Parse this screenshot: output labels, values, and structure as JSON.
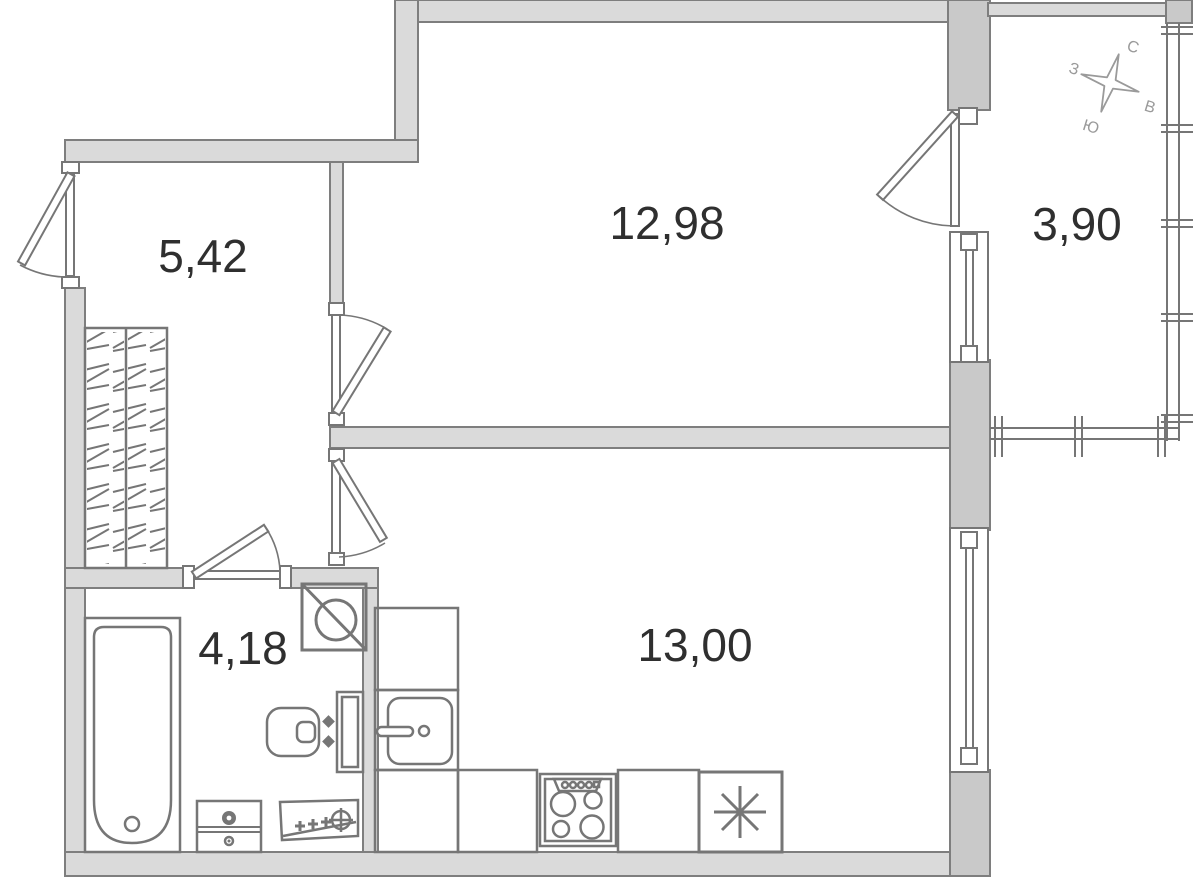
{
  "rooms": [
    {
      "key": "hallway",
      "area": "5,42"
    },
    {
      "key": "living_room",
      "area": "12,98"
    },
    {
      "key": "balcony",
      "area": "3,90"
    },
    {
      "key": "bathroom",
      "area": "4,18"
    },
    {
      "key": "kitchen_living_room",
      "area": "13,00"
    }
  ],
  "compass": {
    "north": "С",
    "east": "В",
    "south": "Ю",
    "west": "З"
  },
  "fixtures": [
    "entrance-door",
    "wardrobe",
    "bathtub",
    "vanity-cabinet",
    "washbasin",
    "toilet",
    "washing-machine",
    "kitchen-counter",
    "kitchen-sink",
    "stove",
    "refrigerator",
    "interior-door",
    "balcony-door",
    "window",
    "balcony-glazing"
  ],
  "colors": {
    "background": "#ffffff",
    "wall_fill": "#dadada",
    "wall_dark": "#c9c9c9",
    "wall_stroke": "#7e7e7e",
    "fixture_stroke": "#767676",
    "label_color": "#2f2f2f",
    "compass_color": "#9a9a9a"
  }
}
